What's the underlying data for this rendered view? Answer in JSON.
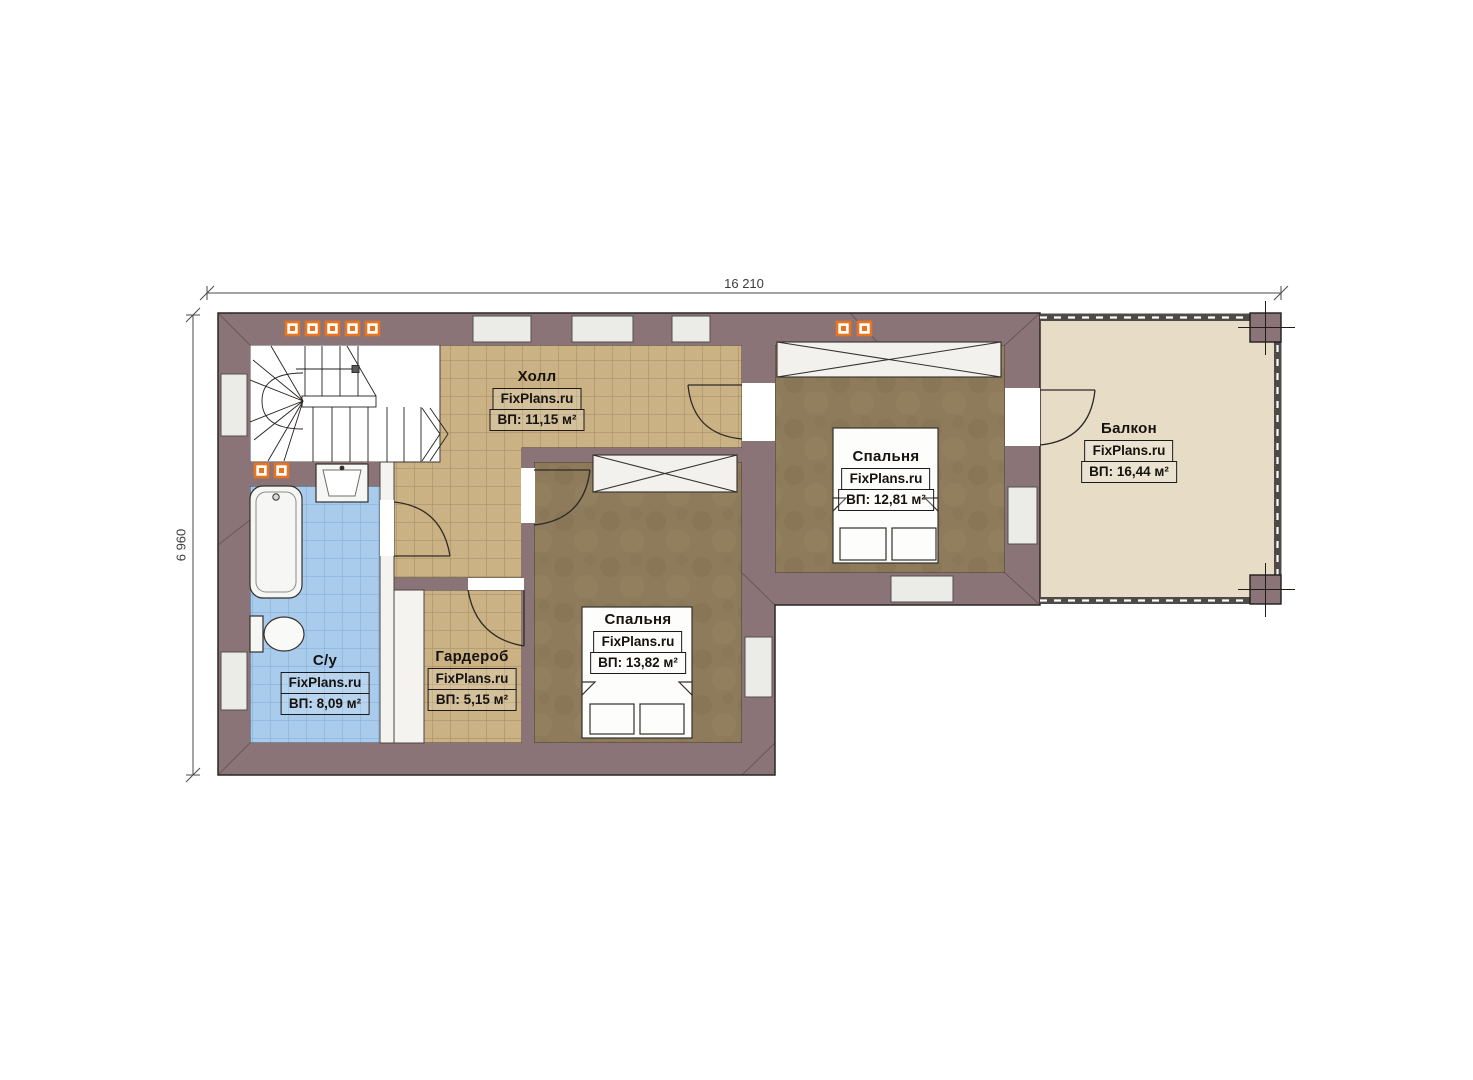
{
  "plan": {
    "watermark": "FixPlans.ru",
    "dimensions": {
      "width": "16 210",
      "height": "6 960"
    },
    "rooms": {
      "hall": {
        "name": "Холл",
        "area": "ВП: 11,15 м²"
      },
      "bedroom_right": {
        "name": "Спальня",
        "area": "ВП: 12,81 м²"
      },
      "balcony": {
        "name": "Балкон",
        "area": "ВП: 16,44 м²"
      },
      "bedroom_center": {
        "name": "Спальня",
        "area": "ВП: 13,82 м²"
      },
      "wardrobe": {
        "name": "Гардероб",
        "area": "ВП: 5,15 м²"
      },
      "bathroom": {
        "name": "С/у",
        "area": "ВП: 8,09 м²"
      }
    },
    "colors": {
      "wall": "#8b7478",
      "hall_floor": "#cbb284",
      "bedroom_floor": "#8d7b5c",
      "bathroom_floor": "#a9cbec",
      "balcony_floor": "#e7ddc7",
      "vent_orange": "#e8741f"
    }
  }
}
